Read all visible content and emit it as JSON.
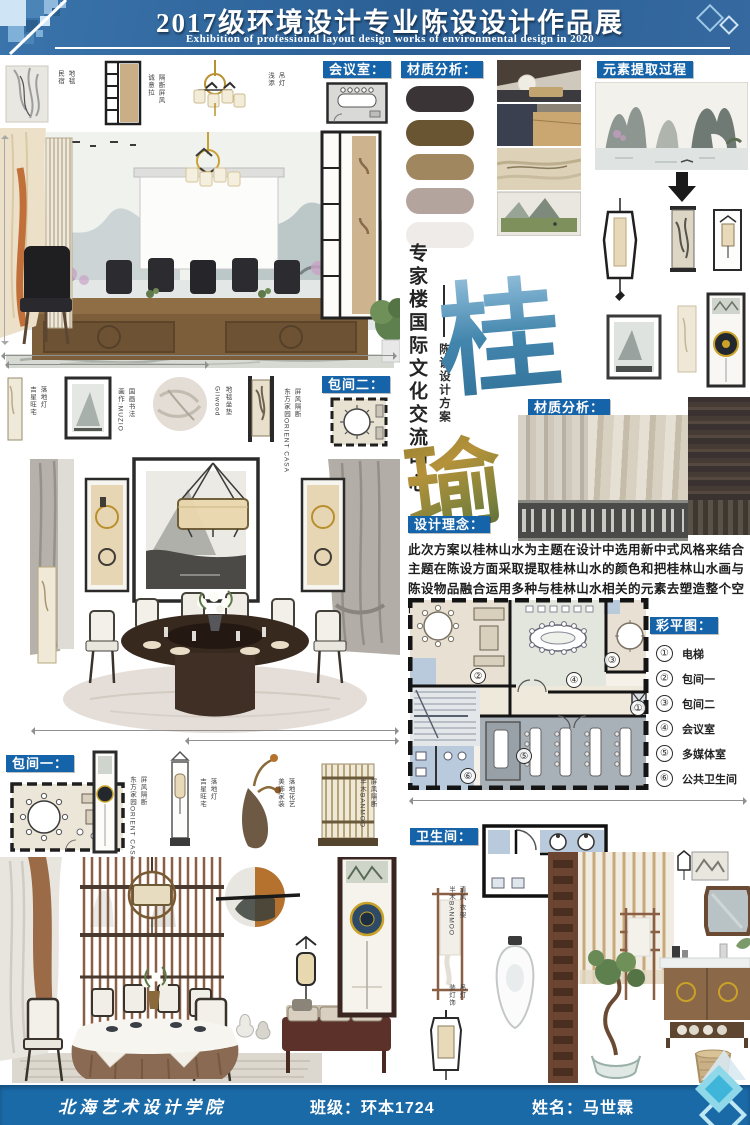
{
  "header": {
    "title": "2017级环境设计专业陈设设计作品展",
    "subtitle": "Exhibition of professional layout design works of environmental design in 2020"
  },
  "footer": {
    "school": "北海艺术设计学院",
    "class_info": "班级：环本1724",
    "name_info": "姓名：马世霖"
  },
  "colors": {
    "label_bg": "#1563a8",
    "header_blue": "#2e6597",
    "footer_blue": "#1b6aa8"
  },
  "labels": {
    "meeting_room": "会议室：",
    "material_analysis": "材质分析：",
    "element_extraction": "元素提取过程",
    "private_room_2": "包间二：",
    "material_analysis_2": "材质分析：",
    "design_concept": "设计理念：",
    "color_plan": "彩平图：",
    "private_room_1": "包间一：",
    "bathroom": "卫生间："
  },
  "vertical_title": {
    "main": "专家楼国际文化交流中心",
    "sub": "陈设设计方案"
  },
  "calligraphy": {
    "char_top": "桂",
    "char_bottom": "瑜"
  },
  "design_concept_text": "此次方案以桂林山水为主题在设计中选用新中式风格来结合主题在陈设方面采取提取桂林山水的颜色和把桂林山水画与陈设物品融合运用多种与桂林山水相关的元素去塑造整个空间突出桂林山水的主题。",
  "material_swatches": [
    "#3a3437",
    "#6a5532",
    "#a1875f",
    "#b3a49d",
    "#eeebe8"
  ],
  "color_plan_legend": [
    {
      "num": "①",
      "label": "电梯"
    },
    {
      "num": "②",
      "label": "包间一"
    },
    {
      "num": "③",
      "label": "包间二"
    },
    {
      "num": "④",
      "label": "会议室"
    },
    {
      "num": "⑤",
      "label": "多媒体室"
    },
    {
      "num": "⑥",
      "label": "公共卫生间"
    }
  ],
  "plan_numbers": {
    "n1": "①",
    "n2": "②",
    "n3": "③",
    "n4": "④",
    "n5": "⑤",
    "n6": "⑥"
  },
  "annotations": {
    "top_row": [
      {
        "brand": "民宿",
        "item": "地毯"
      },
      {
        "brand": "诚意拉",
        "item": "隔断屏风"
      },
      {
        "brand": "浅添",
        "item": "吊灯"
      }
    ],
    "room2_row": [
      {
        "brand": "吉星旺宅",
        "item": "落地灯"
      },
      {
        "brand": "画作:MUZIO",
        "item": "国画书法"
      },
      {
        "brand": "Gilwood",
        "item": "地毯坐垫"
      },
      {
        "brand": "东方家园ORIENT CASA",
        "item": "屏风隔断"
      }
    ],
    "room1_row": [
      {
        "brand": "东方家园ORIENT CASA",
        "item": "屏风隔断"
      },
      {
        "brand": "吉星旺宅",
        "item": "落地灯"
      },
      {
        "brand": "美饰家装",
        "item": "落地花艺"
      },
      {
        "brand": "半木BANMOO",
        "item": "屏风隔断"
      }
    ],
    "bathroom_items": [
      {
        "brand": "半木BANMOO",
        "item": "清风 衣架"
      },
      {
        "brand": "装灯饰",
        "item": "吊灯"
      }
    ]
  }
}
